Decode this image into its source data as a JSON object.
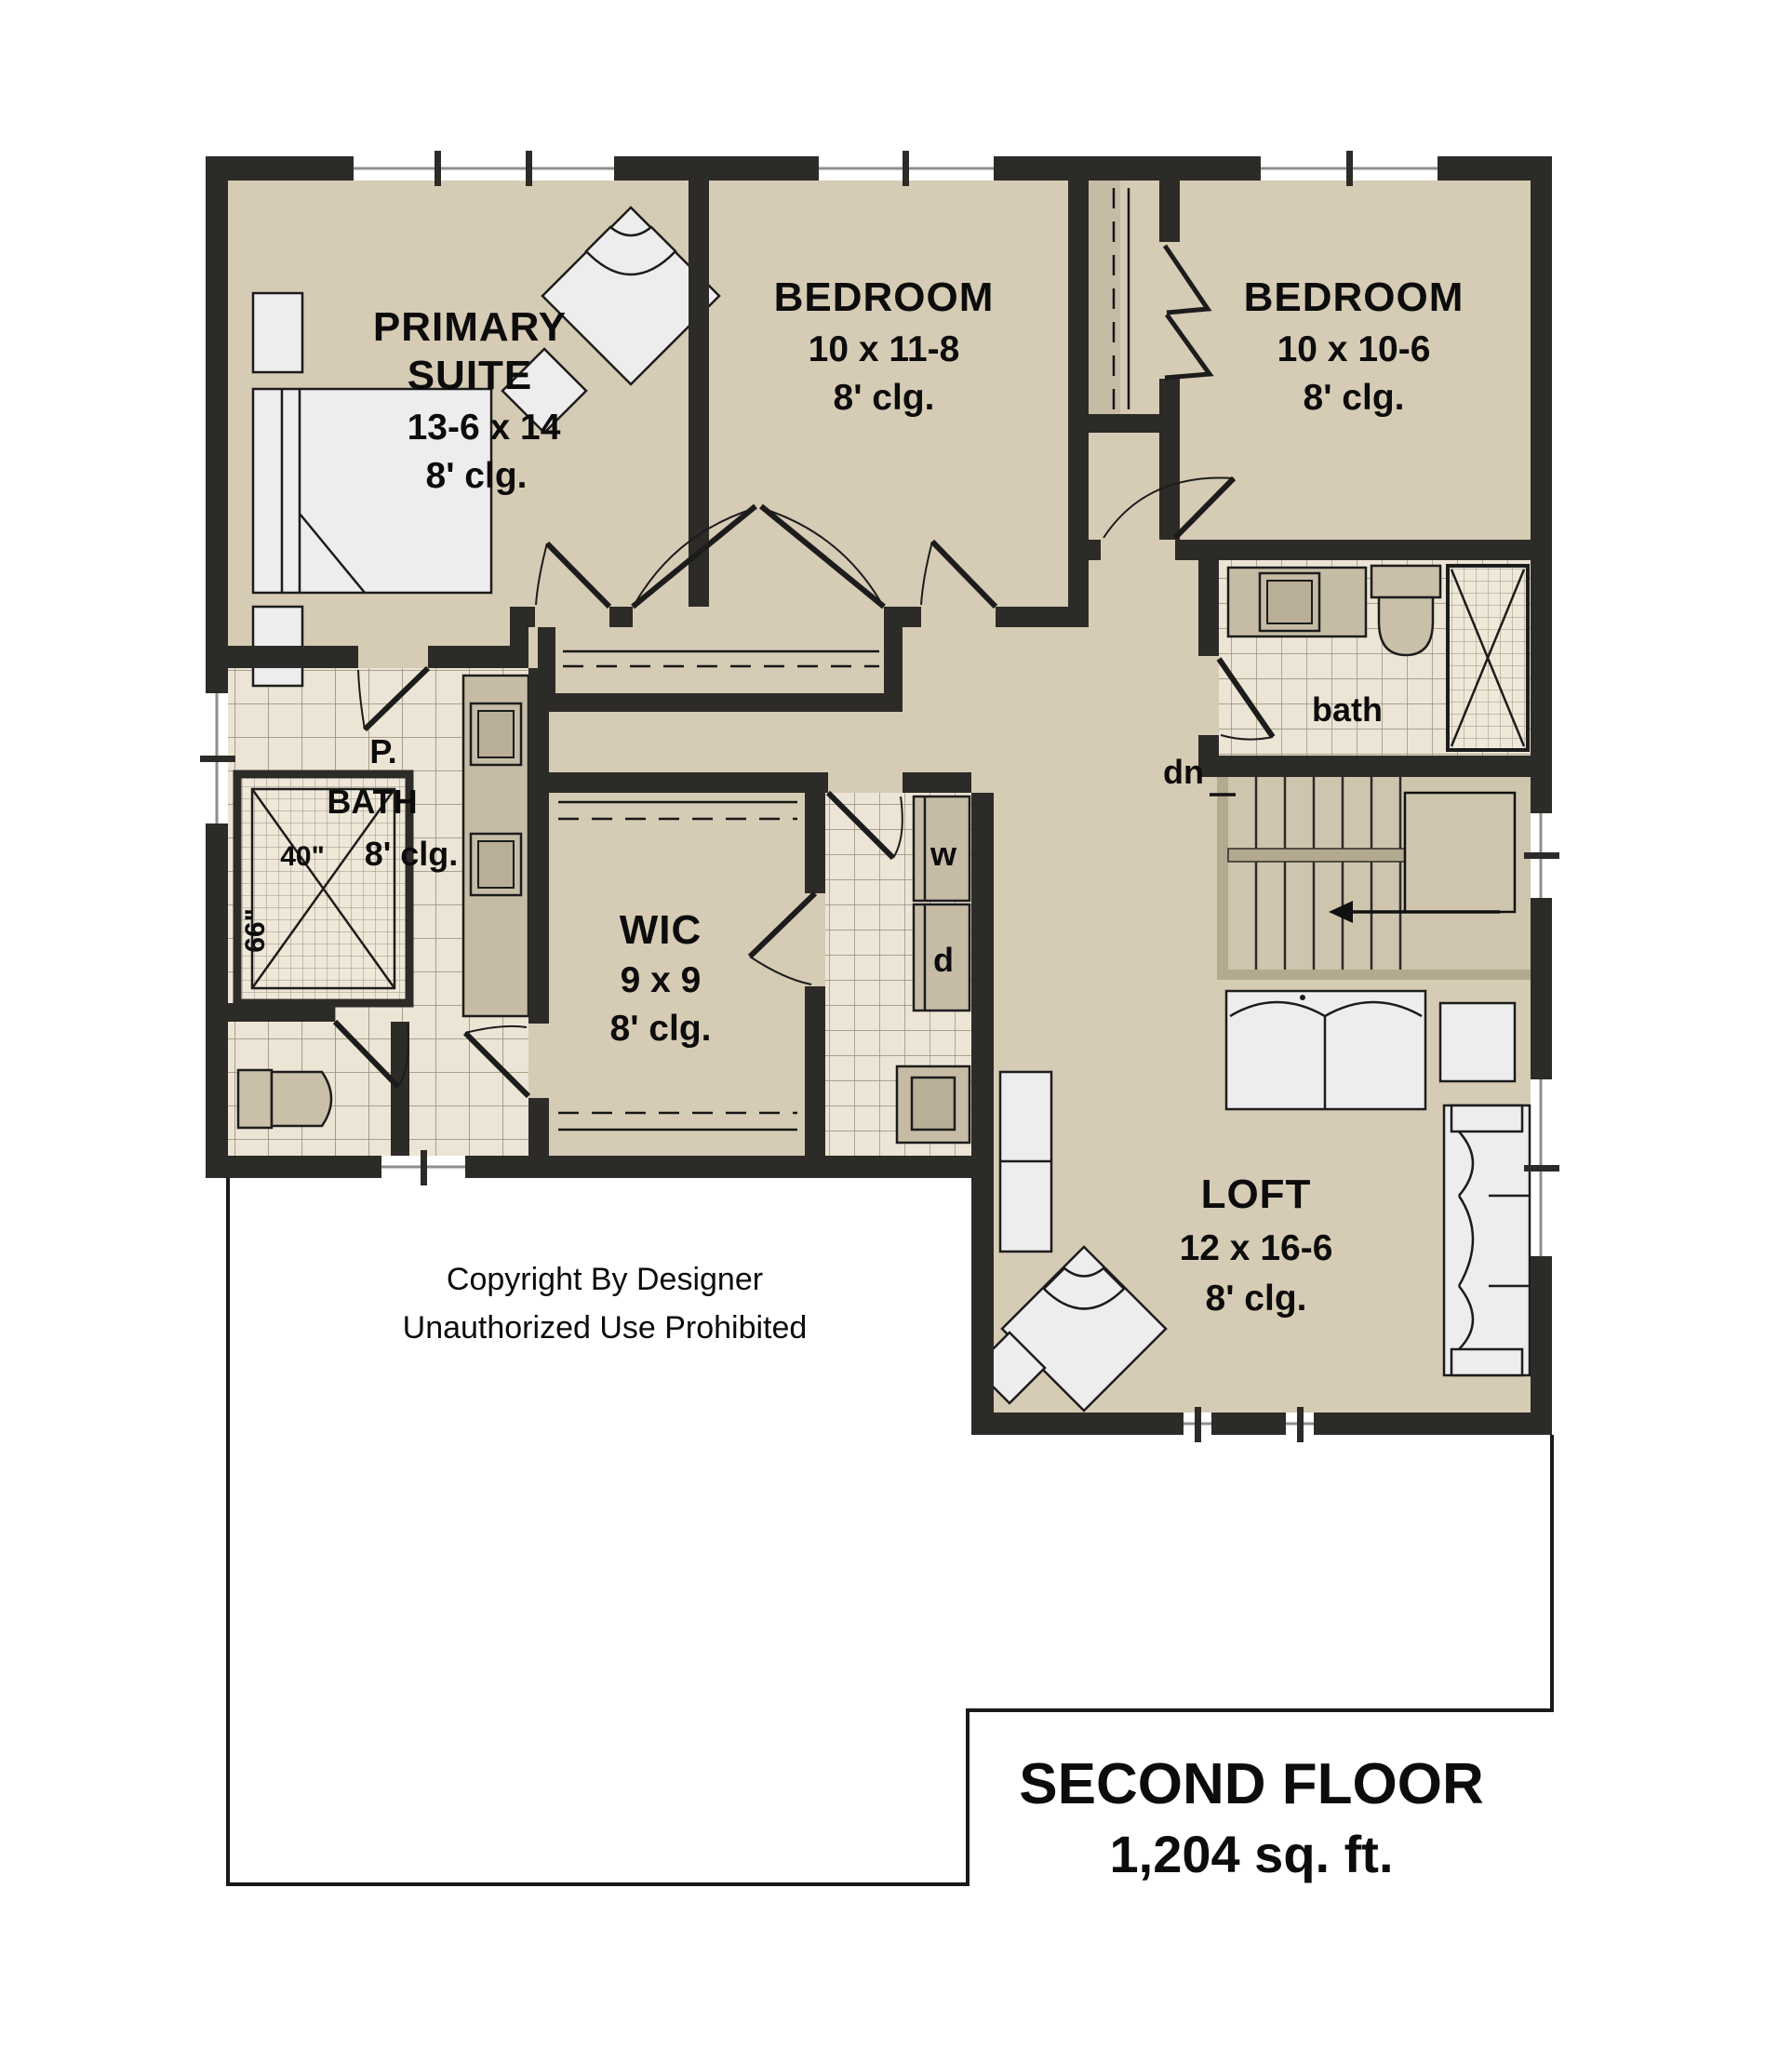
{
  "colors": {
    "wall": "#2d2b27",
    "floor": "#d6cbb4",
    "tile": "#ece4d4",
    "tile_line": "#958d78",
    "shower_tile": "#efe8d8",
    "counter": "#c6bca6",
    "fixture": "#cabfa9",
    "furniture": "#ededed",
    "stair_floor": "#cfc5ae",
    "stair_trim": "#b3a98f",
    "outline": "#1a1a1a"
  },
  "plan": {
    "rooms": {
      "primary": {
        "lines": [
          "PRIMARY",
          "SUITE",
          "13-6 x 14",
          "8' clg."
        ]
      },
      "bedroom1": {
        "lines": [
          "BEDROOM",
          "10 x 11-8",
          "8' clg."
        ]
      },
      "bedroom2": {
        "lines": [
          "BEDROOM",
          "10 x 10-6",
          "8' clg."
        ]
      },
      "bath": {
        "label": "bath"
      },
      "pbath": {
        "lines": [
          "P.",
          "BATH",
          "8' clg."
        ],
        "shower_width": "40\"",
        "shower_depth": "66\""
      },
      "wic": {
        "lines": [
          "WIC",
          "9 x 9",
          "8' clg."
        ]
      },
      "loft": {
        "lines": [
          "LOFT",
          "12 x 16-6",
          "8' clg."
        ]
      },
      "laundry": {
        "washer": "w",
        "dryer": "d"
      },
      "stairs": {
        "down": "dn"
      }
    },
    "copyright": {
      "line1": "Copyright By Designer",
      "line2": "Unauthorized Use Prohibited"
    },
    "footer": {
      "title": "SECOND FLOOR",
      "area": "1,204 sq. ft."
    }
  }
}
